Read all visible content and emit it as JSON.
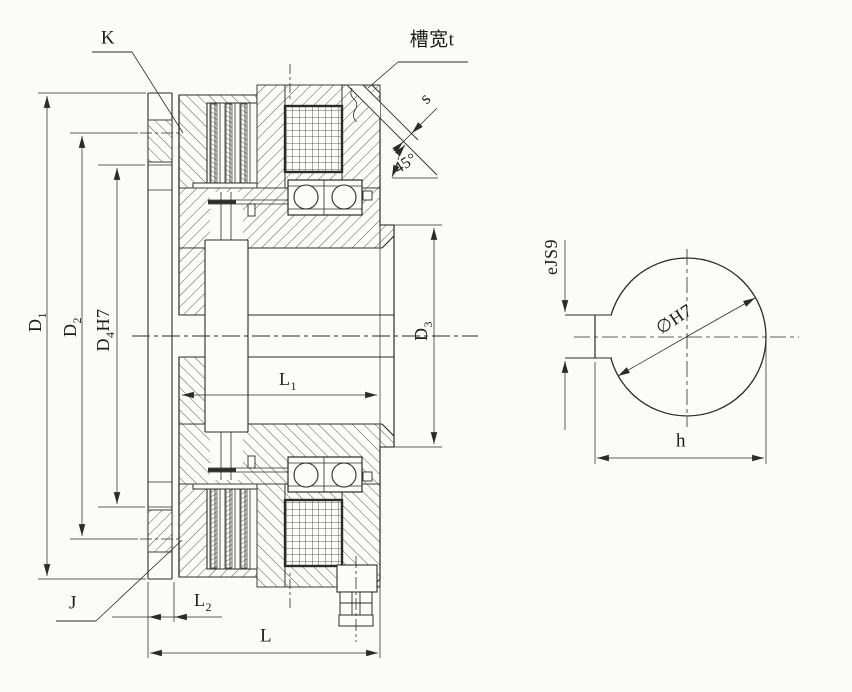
{
  "colors": {
    "background": "#fbfbf9",
    "line": "#2b2b2b",
    "dimension_line": "#333333"
  },
  "dims": {
    "k": "K",
    "j": "J",
    "slot_width": "槽宽t",
    "chamfer_depth": "s",
    "chamfer_angle": "45°",
    "d1": {
      "base": "D",
      "sub": "1"
    },
    "d2": {
      "base": "D",
      "sub": "2"
    },
    "d4": {
      "base": "D",
      "sub": "4",
      "suffix": "H7"
    },
    "d3": {
      "base": "D",
      "sub": "3"
    },
    "l1": {
      "base": "L",
      "sub": "1"
    },
    "l2": {
      "base": "L",
      "sub": "2"
    },
    "l": "L",
    "keyway_width": "eJS9",
    "bore_diameter": "∅H7",
    "keyway_span": "h"
  }
}
